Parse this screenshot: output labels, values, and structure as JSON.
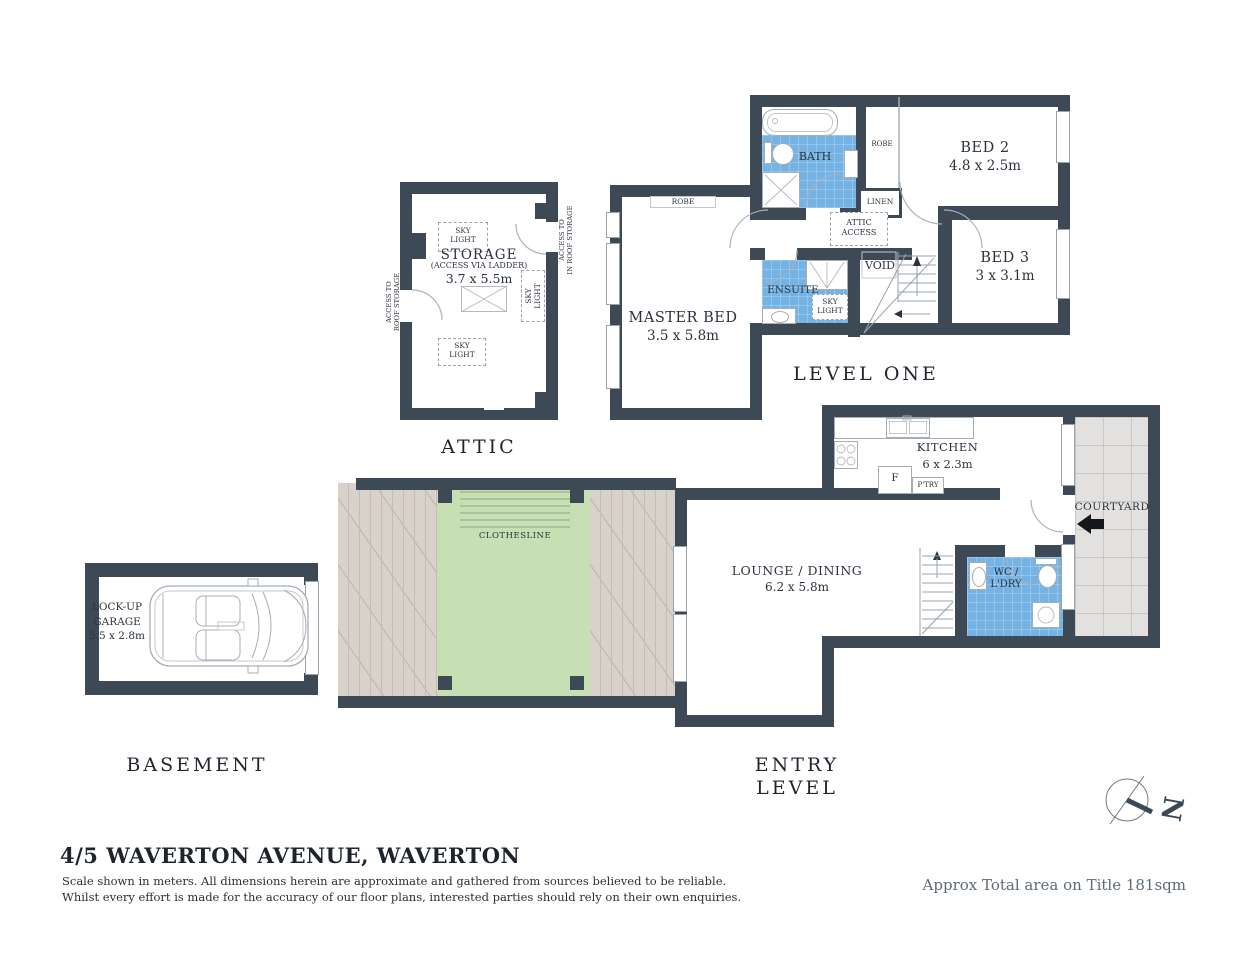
{
  "footer": {
    "title": "4/5 WAVERTON AVENUE, WAVERTON",
    "disclaimer1": "Scale shown in meters. All dimensions herein are approximate and gathered from sources believed to be  reliable.",
    "disclaimer2": "Whilst every effort is made for the accuracy of our floor plans, interested parties should rely on their own enquiries.",
    "area_note": "Approx Total area on Title 181sqm"
  },
  "compass": {
    "north": "N"
  },
  "sections": {
    "attic": "ATTIC",
    "level_one": "LEVEL ONE",
    "basement": "BASEMENT",
    "entry_level": "ENTRY LEVEL"
  },
  "attic": {
    "storage_name": "STORAGE",
    "storage_access": "(ACCESS VIA LADDER)",
    "storage_dims": "3.7 x 5.5m",
    "skylight": "SKY\nLIGHT",
    "access_roof_left": "ACCESS TO\nROOF STORAGE",
    "access_roof_right": "ACCESS TO\nIN ROOF STORAGE"
  },
  "level_one": {
    "master_bed_name": "MASTER BED",
    "master_bed_dims": "3.5 x 5.8m",
    "bed2_name": "BED 2",
    "bed2_dims": "4.8 x 2.5m",
    "bed3_name": "BED 3",
    "bed3_dims": "3 x 3.1m",
    "bath": "BATH",
    "ensuite": "ENSUITE",
    "void": "VOID",
    "robe_master": "ROBE",
    "robe_hall": "ROBE",
    "linen": "LINEN",
    "attic_access": "ATTIC\nACCESS",
    "skylight": "SKY\nLIGHT"
  },
  "entry_level": {
    "lounge_name": "LOUNGE / DINING",
    "lounge_dims": "6.2 x 5.8m",
    "kitchen_name": "KITCHEN",
    "kitchen_dims": "6 x 2.3m",
    "courtyard": "COURTYARD",
    "wc": "WC /\nL'DRY",
    "fridge": "F",
    "pantry": "P'TRY",
    "clothesline": "CLOTHESLINE"
  },
  "basement": {
    "garage": "LOCK-UP\nGARAGE\n5.5 x 2.8m"
  }
}
